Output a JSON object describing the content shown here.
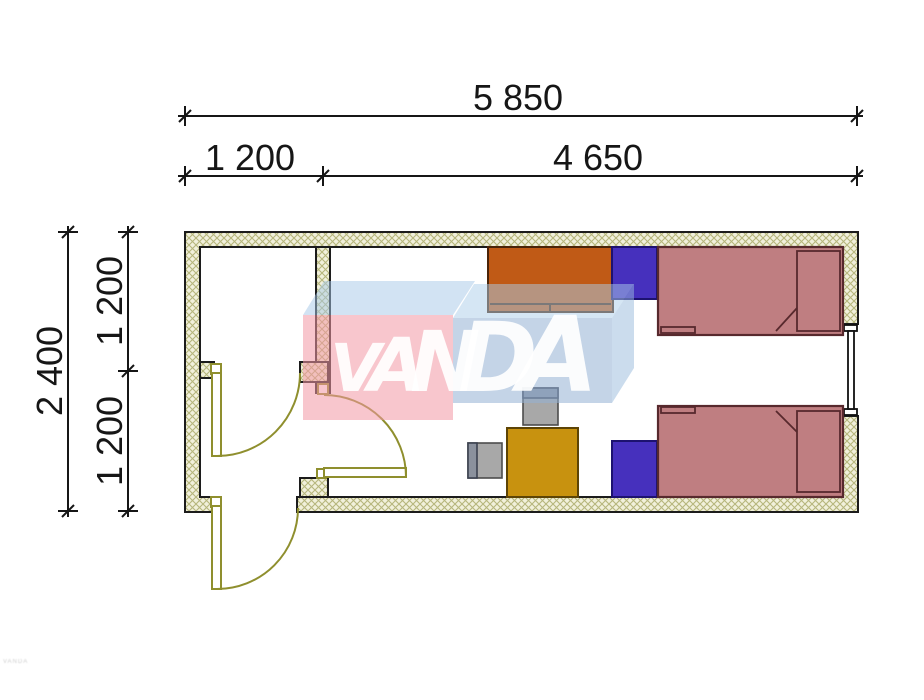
{
  "dims": {
    "top_total": "5 850",
    "top_seg_left": "1 200",
    "top_seg_right": "4 650",
    "left_total": "2 400",
    "left_seg_top": "1 200",
    "left_seg_bottom": "1 200"
  },
  "watermark": {
    "letters": [
      "V",
      "A",
      "N",
      "D",
      "A"
    ]
  },
  "footer": {
    "micro_text": "VANDA"
  },
  "colors": {
    "wall_fill": "#f1f0db",
    "wall_hatch": "#b6b67c",
    "wall_outline": "#1c1c1c",
    "door": "#8f8f2e",
    "bed": "#bf7e81",
    "nightstand": "#4630bd",
    "wardrobe": "#c05a16",
    "desk": "#c8920f",
    "chair": "#a8a8a8",
    "chair_back": "#8b919d",
    "dim": "#161616",
    "wm_pink": "rgba(242,151,164,0.55)",
    "wm_blue": "rgba(147,176,211,0.55)",
    "wm_top_pink": "rgba(166,200,231,0.50)",
    "wm_top_blue": "rgba(172,205,234,0.50)",
    "wm_side_blue": "rgba(152,186,220,0.50)",
    "wm_text": "rgba(255,255,255,0.92)"
  }
}
